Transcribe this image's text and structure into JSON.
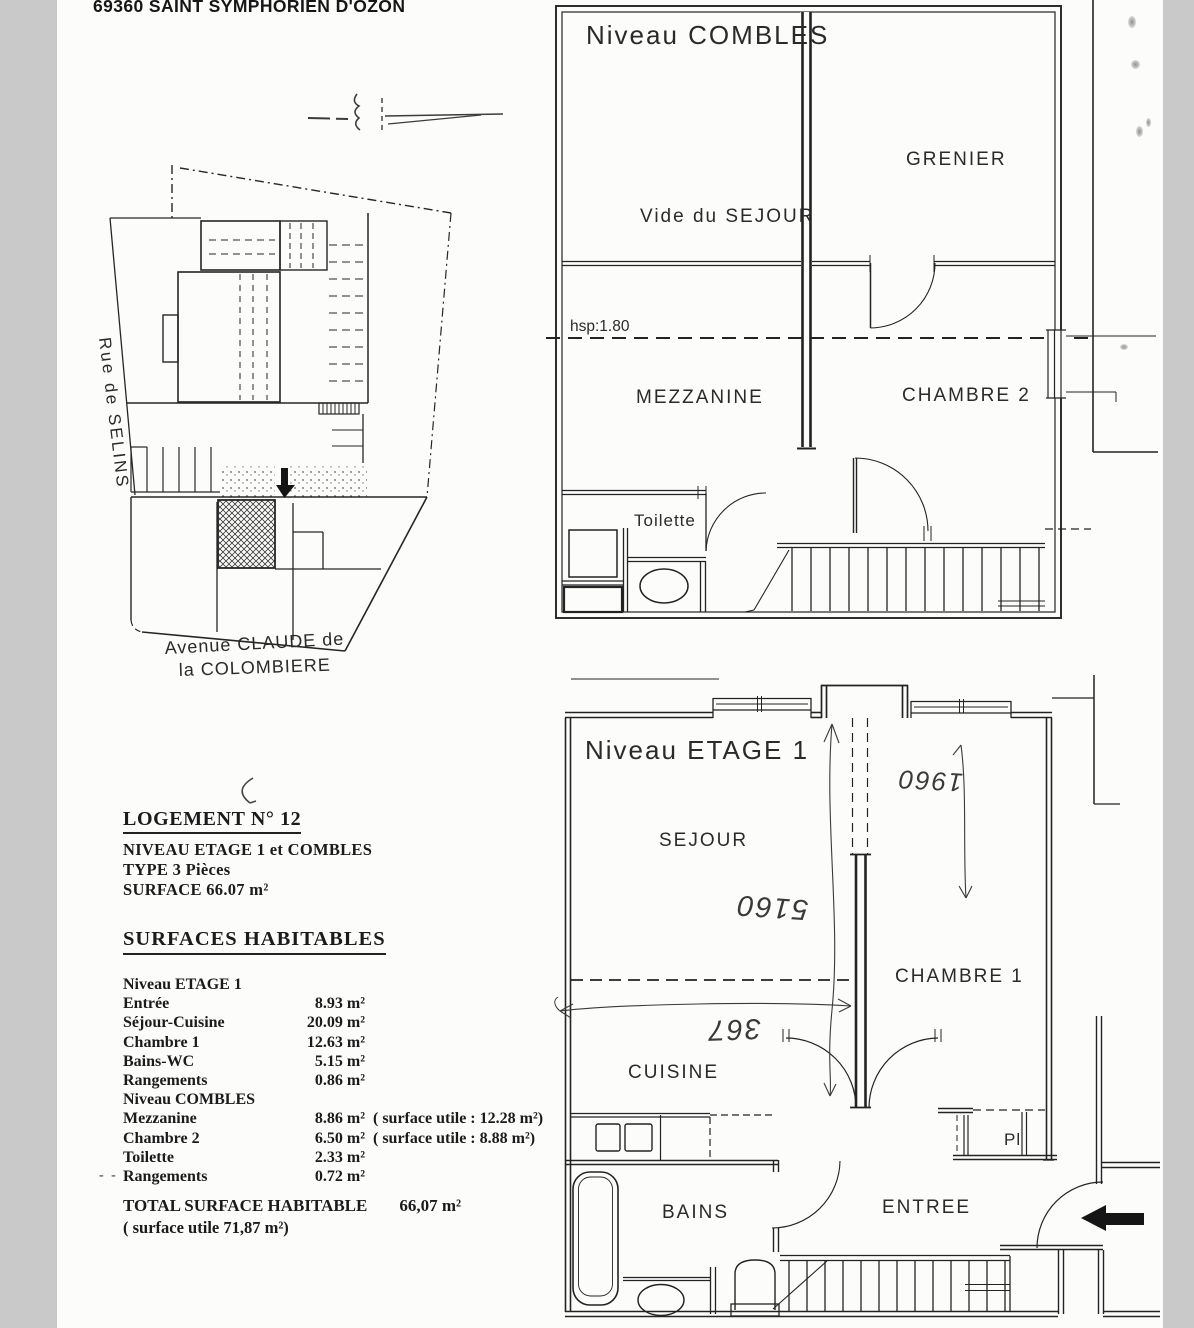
{
  "header": {
    "address": "69360 SAINT SYMPHORIEN D'OZON"
  },
  "site_plan": {
    "street_left": "Rue de SELINS",
    "avenue_line1": "Avenue CLAUDE de",
    "avenue_line2": "la COLOMBIERE"
  },
  "combles_plan": {
    "title": "Niveau COMBLES",
    "room_vide": "Vide du SEJOUR",
    "room_grenier": "GRENIER",
    "room_mezzanine": "MEZZANINE",
    "room_chambre2": "CHAMBRE 2",
    "room_toilette": "Toilette",
    "hsp_label": "hsp:1.80"
  },
  "etage1_plan": {
    "title": "Niveau ETAGE 1",
    "room_sejour": "SEJOUR",
    "room_chambre1": "CHAMBRE 1",
    "room_cuisine": "CUISINE",
    "room_bains": "BAINS",
    "room_entree": "ENTREE",
    "room_placard": "Pl",
    "hand_dim_width": "367",
    "hand_dim_length": "5160",
    "hand_dim_right": "1960"
  },
  "info_block": {
    "logement_title": "LOGEMENT N° 12",
    "niveau_line": "NIVEAU ETAGE 1 et COMBLES",
    "type_line": "TYPE 3 Pièces",
    "surface_line": "SURFACE 66.07 m²",
    "surfaces_title": "SURFACES HABITABLES",
    "rows": [
      {
        "label": "Niveau ETAGE 1",
        "value": "",
        "note": ""
      },
      {
        "label": "Entrée",
        "value": "8.93 m²",
        "note": ""
      },
      {
        "label": "Séjour-Cuisine",
        "value": "20.09 m²",
        "note": ""
      },
      {
        "label": "Chambre 1",
        "value": "12.63 m²",
        "note": ""
      },
      {
        "label": "Bains-WC",
        "value": "5.15 m²",
        "note": ""
      },
      {
        "label": "Rangements",
        "value": "0.86 m²",
        "note": ""
      },
      {
        "label": "Niveau COMBLES",
        "value": "",
        "note": ""
      },
      {
        "label": "Mezzanine",
        "value": "8.86 m²",
        "note": "( surface utile :  12.28 m²)"
      },
      {
        "label": "Chambre 2",
        "value": "6.50 m²",
        "note": "( surface utile :   8.88 m²)"
      },
      {
        "label": "Toilette",
        "value": "2.33 m²",
        "note": ""
      },
      {
        "label": "Rangements",
        "value": "0.72 m²",
        "note": ""
      }
    ],
    "hand_marks": "- -",
    "total_label": "TOTAL SURFACE HABITABLE",
    "total_value": "66,07 m²",
    "total_note": "( surface utile 71,87 m²)"
  }
}
